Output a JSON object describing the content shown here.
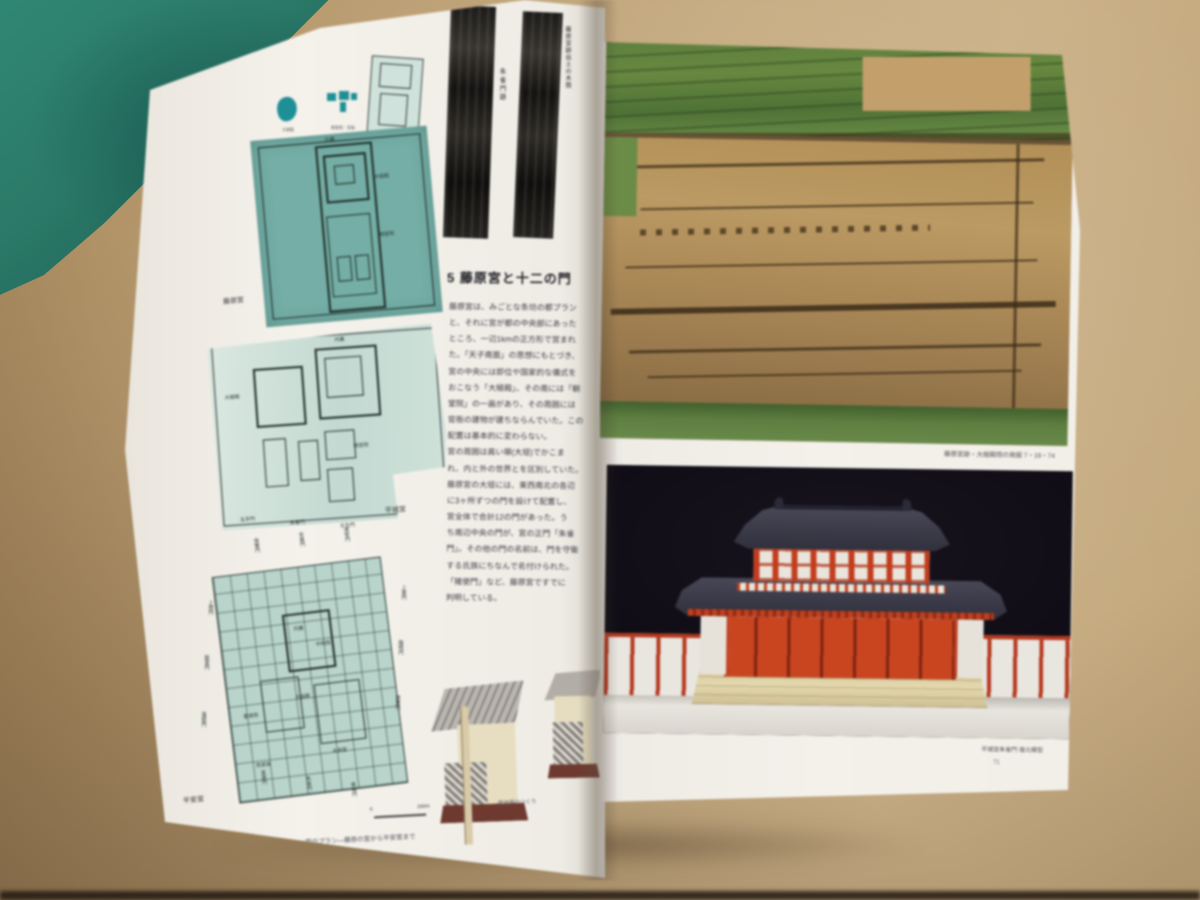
{
  "scene": {
    "table_color": "#bda075",
    "green_object_color": "#2a7a69",
    "page_color": "#f4f1eb"
  },
  "left_page": {
    "legend": {
      "items": [
        {
          "icon": "teal-blob-icon",
          "label": "大極殿"
        },
        {
          "icon": "teal-glyph-icon",
          "label": "朝堂院・官衙"
        },
        {
          "icon": "plan-thumbnail-icon",
          "label": "宮城(大内裏)"
        }
      ]
    },
    "strip_caption_a": "朱雀門跡",
    "strip_caption_b": "藤原宮跡出土の木簡",
    "map1": {
      "caption": "藤原宮",
      "labels": [
        "内裏",
        "大極殿",
        "朝堂院"
      ]
    },
    "map2": {
      "caption": "平城宮",
      "labels": [
        "内裏",
        "大極殿",
        "朝堂院"
      ],
      "gates_bottom": [
        "玉手門",
        "朱雀門",
        "壬生門"
      ]
    },
    "map3": {
      "caption": "平安宮",
      "labels": [
        "内裏",
        "大極殿",
        "豊楽院",
        "中和院",
        "太政官",
        "民部省"
      ],
      "gates_top": [
        "偉鑒門",
        "安嘉門",
        "達智門"
      ],
      "gates_left": [
        "上西門",
        "殷富門",
        "藻壁門"
      ],
      "gates_right": [
        "上東門",
        "陽明門",
        "待賢門"
      ],
      "gates_bottom": [
        "皇嘉門",
        "朱雀門",
        "美福門"
      ]
    },
    "scale": {
      "zero": "0",
      "label": "200m"
    },
    "bottom_caption": "宮のプラン―藤原の宮から平安宮まで",
    "article": {
      "heading": "5 藤原宮と十二の門",
      "body": "藤原宮は、みごとな条坊の都プラン\nと、それに宮が都の中央部にあった\nところ、一辺1kmの正方形で営まれ\nた。「天子南面」の思想にもとづき、\n宮の中央には即位や国家的な儀式を\nおこなう「大極殿」、その南には「朝\n堂院」の一画があり、その周囲には\n官衙の建物が建ちならんでいた。この\n配置は基本的に変わらない。\n宮の周囲は高い塀(大垣)でかこま\nれ、内と外の世界とを区別していた。\n藤原宮の大垣には、東西南北の各辺\nに3ヶ所ずつの門を設けて配置し、\n宮全体で合計12の門があった。う\nち南辺中央の門が、宮の正門「朱雀\n門」。その他の門の名前は、門を守衛\nする氏族にちなんで名付けられた。\n「猪使門」など、藤原宮ですでに\n判明している。"
    },
    "drawings_caption": "築地塀のつくり"
  },
  "right_page": {
    "top_photo_caption": "藤原宮跡・大極殿院の発掘 7・19・74",
    "bottom_photo_caption": "平城宮朱雀門 復元模型",
    "page_number": "71"
  }
}
